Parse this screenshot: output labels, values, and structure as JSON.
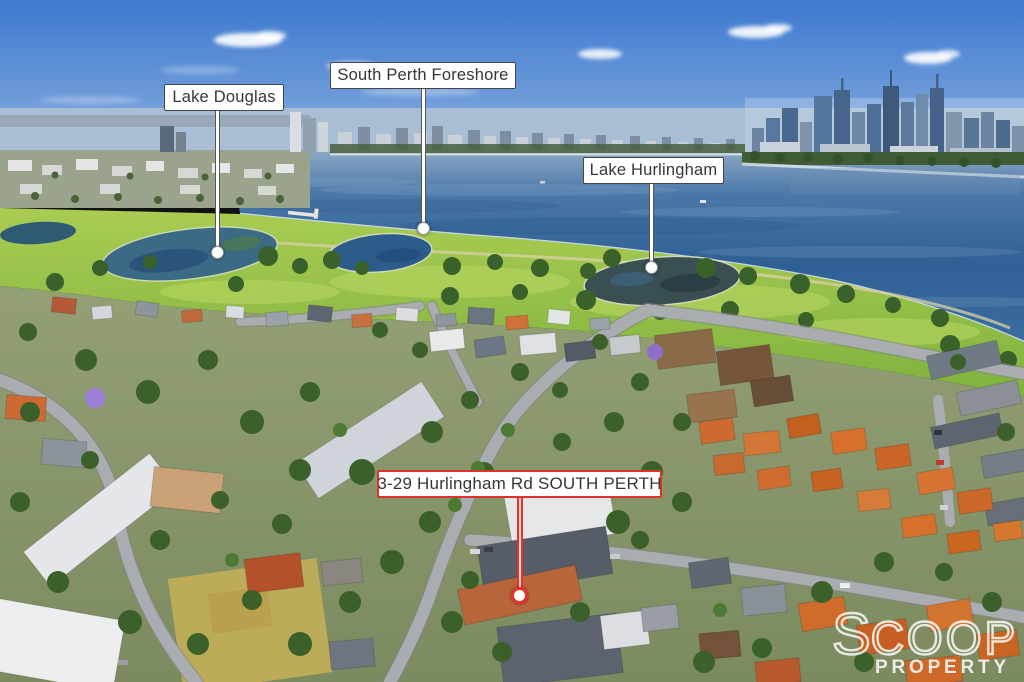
{
  "callouts": [
    {
      "id": "lake-douglas",
      "text": "Lake Douglas"
    },
    {
      "id": "south-perth-foreshore",
      "text": "South Perth Foreshore"
    },
    {
      "id": "lake-hurlingham",
      "text": "Lake Hurlingham"
    },
    {
      "id": "property-address",
      "text": "3-29 Hurlingham Rd SOUTH PERTH"
    }
  ],
  "watermark": {
    "initial": "S",
    "rest": "COOP",
    "line2": "PROPERTY"
  },
  "colors": {
    "callout_bg": "#ffffff",
    "callout_border": "#474747",
    "callout_text": "#363636",
    "accent_red": "#df352b",
    "watermark_white": "#ffffff"
  }
}
